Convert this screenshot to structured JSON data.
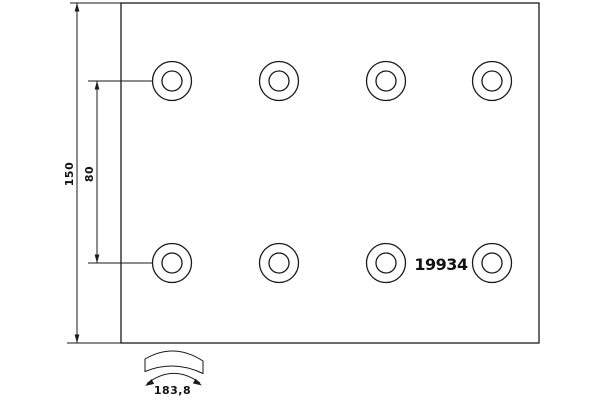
{
  "drawing": {
    "type": "brake-lining-technical-drawing",
    "part_number": "19934",
    "dimensions": {
      "plate_height": "150",
      "hole_row_spacing": "80",
      "arc_length": "183,8"
    },
    "holes": {
      "rows": 2,
      "per_row": 4,
      "total": 8,
      "style": "concentric-circles"
    },
    "colors": {
      "line": "#1a1a1a",
      "background": "#ffffff",
      "text": "#111111"
    }
  }
}
